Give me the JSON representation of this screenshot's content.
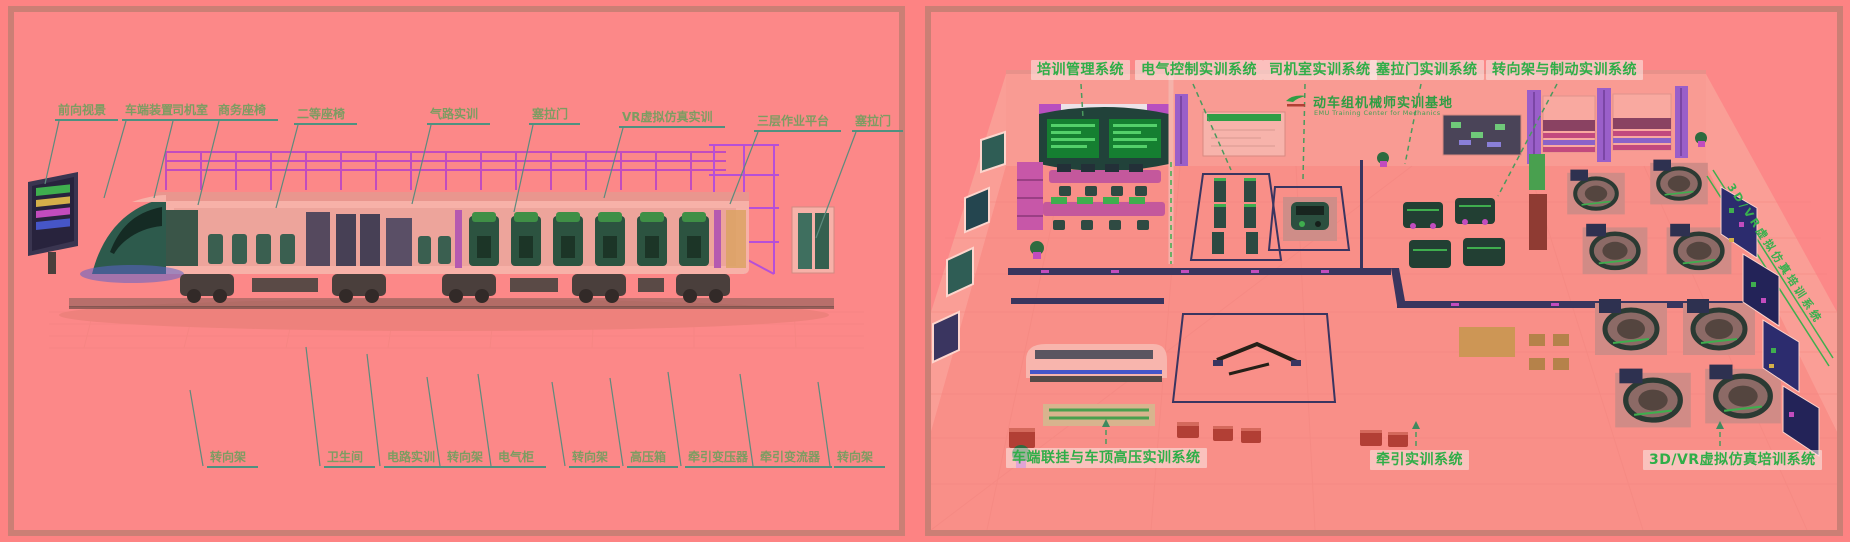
{
  "left_panel": {
    "top_labels": [
      "前向视景",
      "车端装置",
      "司机室",
      "商务座椅",
      "二等座椅",
      "气路实训",
      "塞拉门",
      "VR虚拟仿真实训",
      "三层作业平台",
      "塞拉门"
    ],
    "bottom_labels": [
      "转向架",
      "卫生间",
      "电路实训",
      "转向架",
      "电气柜",
      "转向架",
      "高压箱",
      "牵引变压器",
      "牵引变流器",
      "转向架"
    ]
  },
  "right_panel": {
    "top_labels": [
      "培训管理系统",
      "电气控制实训系统",
      "司机室实训系统",
      "塞拉门实训系统",
      "转向架与制动实训系统"
    ],
    "bottom_labels": [
      "车端联挂与车顶高压实训系统",
      "牵引实训系统",
      "3D/VR虚拟仿真培训系统"
    ],
    "wall_title": "动车组机械师实训基地",
    "wall_subtitle": "EMU Training Center for Mechanics",
    "side_wall_text": "3D/VR虚拟仿真培训系统"
  },
  "colors": {
    "background": "#fd8383",
    "panel_border": "#cb7f75",
    "left_label_green": "#7d9c62",
    "system_label_green": "#2fae48",
    "accent_magenta": "#c24cbe",
    "aisle_navy": "#39355e",
    "led_green": "#1d9a38"
  }
}
